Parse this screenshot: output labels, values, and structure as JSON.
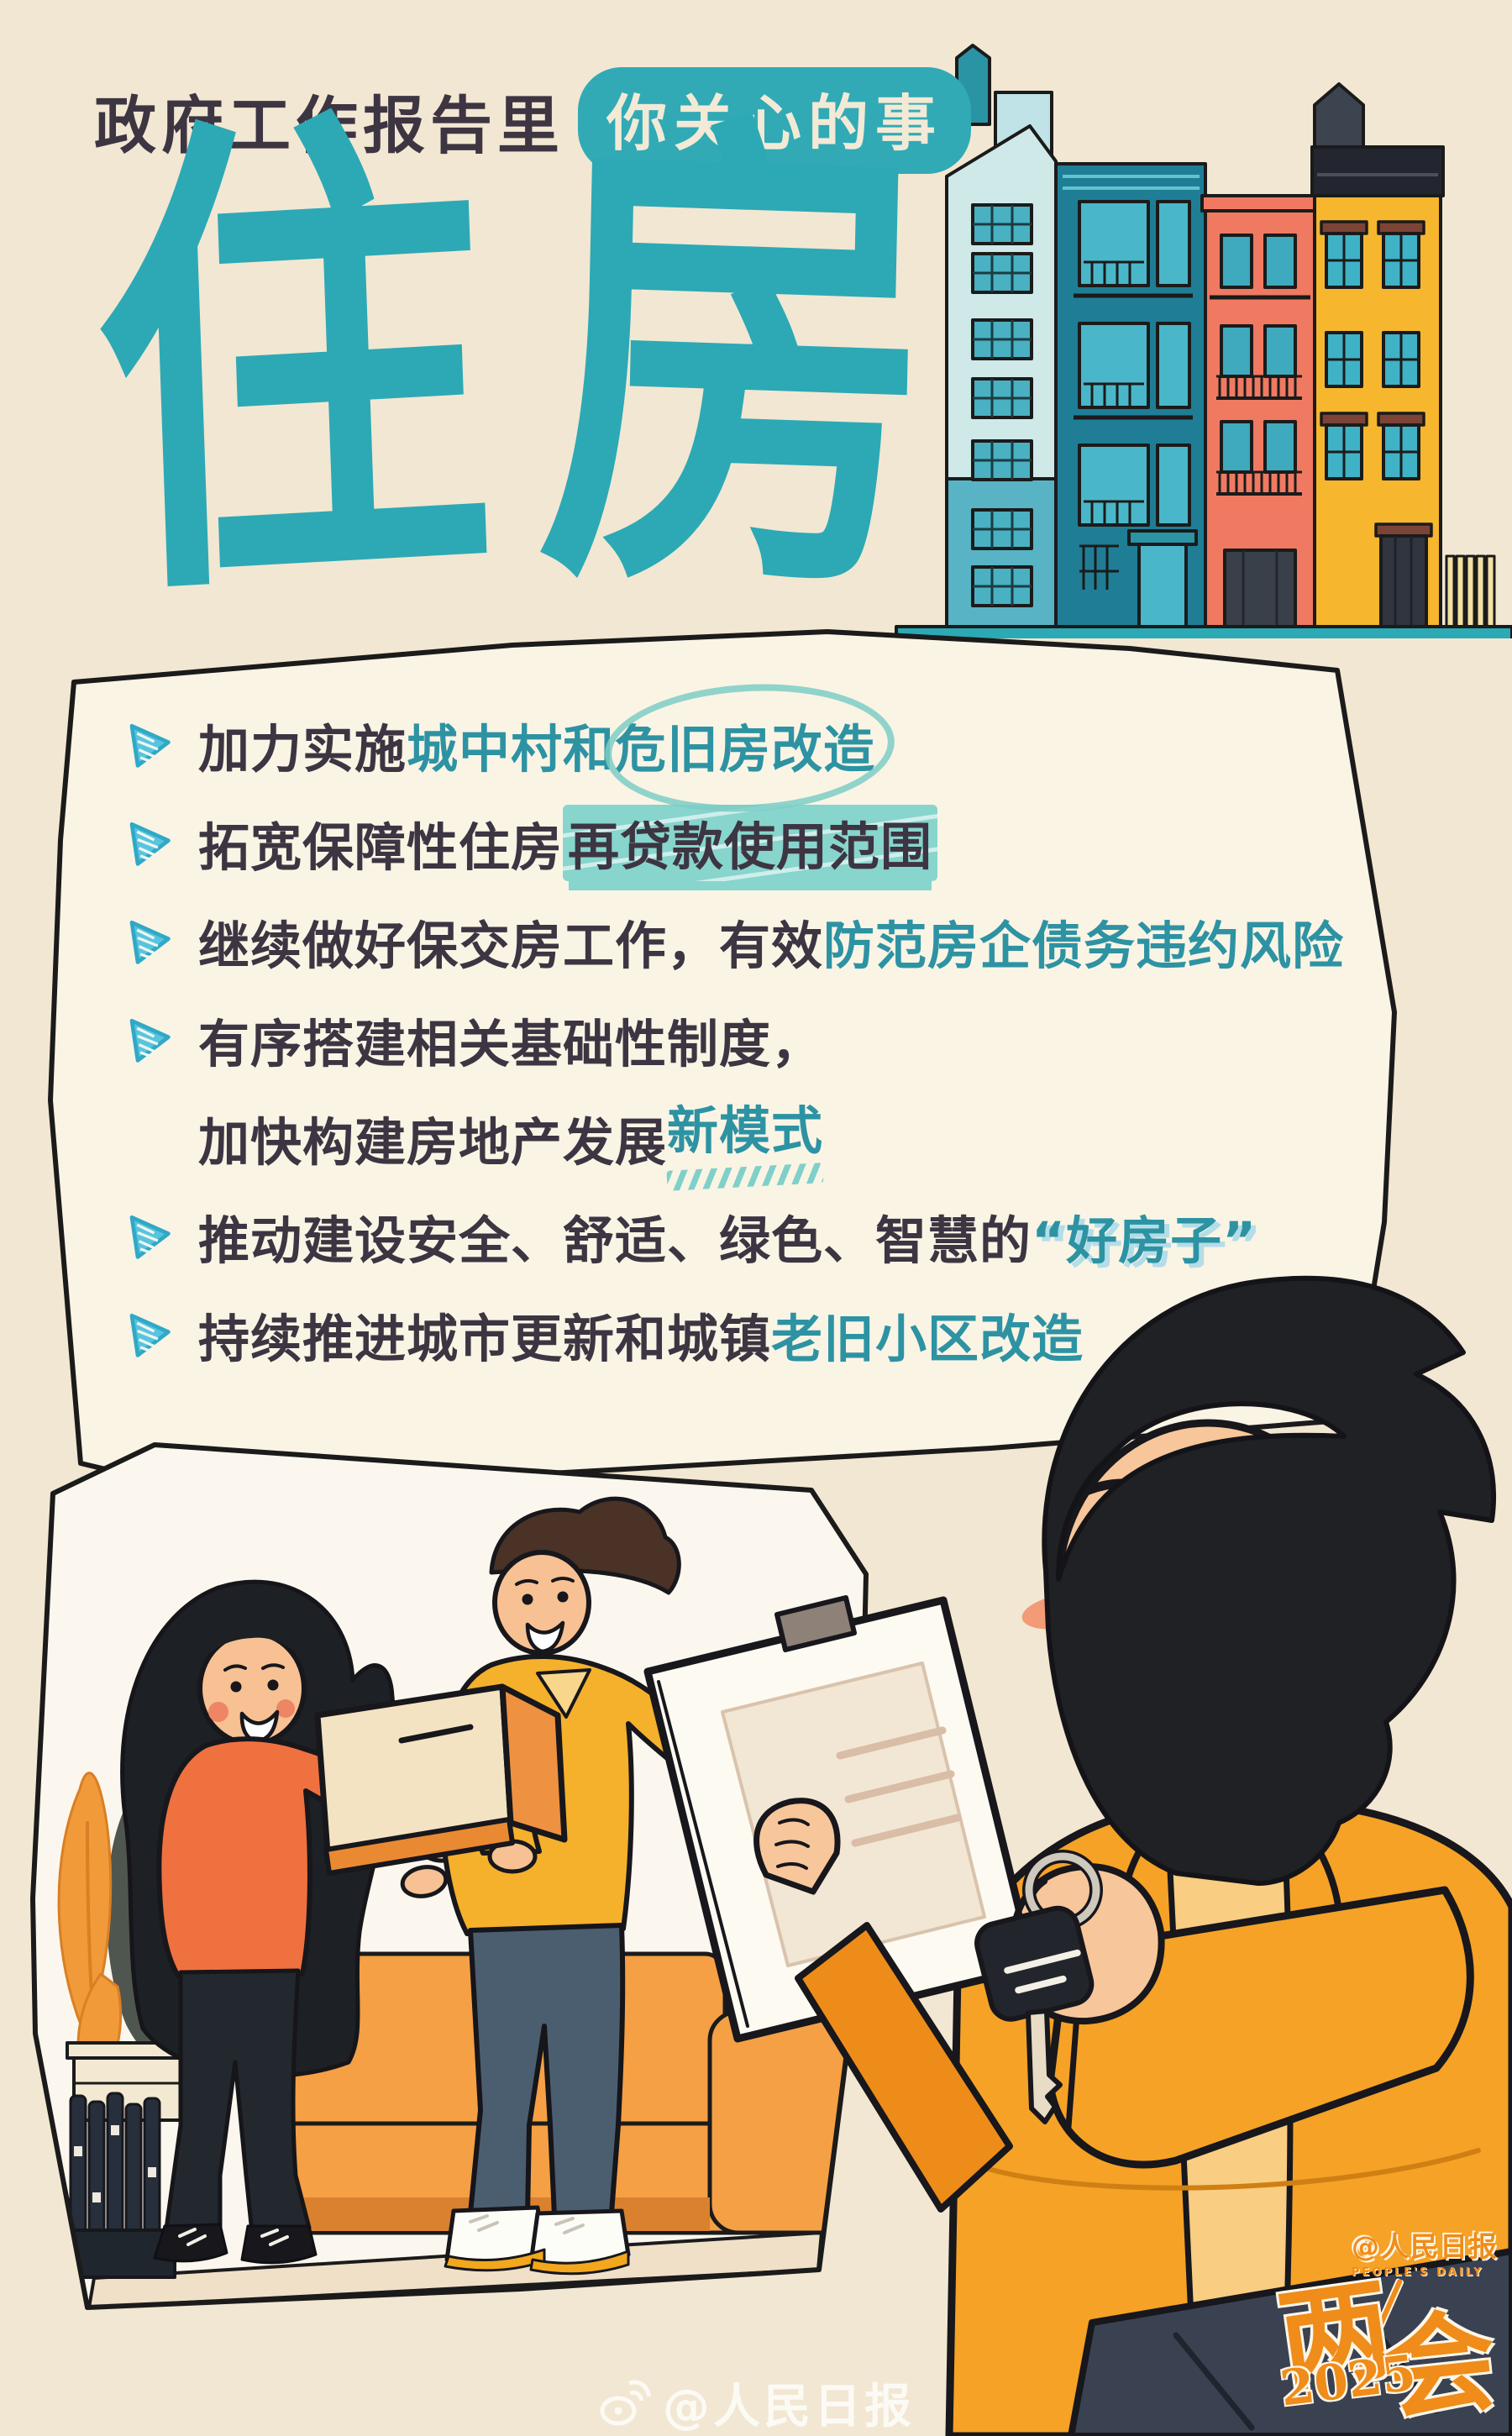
{
  "header": {
    "prefix": "政府工作报告里",
    "pill": "你关心的事"
  },
  "title": {
    "char1": "住",
    "char2": "房",
    "full": "住房"
  },
  "bullets": {
    "items": [
      {
        "lines": [
          {
            "arrow": true,
            "segs": [
              {
                "t": "加力实施",
                "c": "dark"
              },
              {
                "t": "城中村和",
                "c": "teal"
              },
              {
                "t": "危旧房改造",
                "c": "circled"
              }
            ]
          }
        ]
      },
      {
        "lines": [
          {
            "arrow": true,
            "segs": [
              {
                "t": "拓宽保障性住房",
                "c": "dark"
              },
              {
                "t": "再贷款使用范围",
                "c": "hl"
              }
            ]
          }
        ]
      },
      {
        "lines": [
          {
            "arrow": true,
            "segs": [
              {
                "t": "继续做好保交房工作，有效",
                "c": "dark"
              },
              {
                "t": "防范房企债务违约风险",
                "c": "teal"
              }
            ]
          }
        ]
      },
      {
        "lines": [
          {
            "arrow": true,
            "segs": [
              {
                "t": "有序搭建相关基础性制度，",
                "c": "dark"
              }
            ]
          },
          {
            "arrow": false,
            "segs": [
              {
                "t": "加快构建房地产发展",
                "c": "dark"
              },
              {
                "t": "新模式",
                "c": "squig"
              }
            ]
          }
        ]
      },
      {
        "lines": [
          {
            "arrow": true,
            "segs": [
              {
                "t": "推动建设安全、舒适、绿色、智慧的",
                "c": "dark"
              },
              {
                "t": "“好房子”",
                "c": "quote"
              }
            ]
          }
        ]
      },
      {
        "lines": [
          {
            "arrow": true,
            "segs": [
              {
                "t": "持续推进城市更新和城镇",
                "c": "dark"
              },
              {
                "t": "老旧小区改造",
                "c": "teal"
              }
            ]
          }
        ]
      }
    ]
  },
  "watermark": {
    "text": "@人民日报",
    "icon": "weibo-icon"
  },
  "logo": {
    "hui1": "两",
    "hui2": "会",
    "year": "2025",
    "brand": "@人民日报",
    "brand_sub": "PEOPLE'S DAILY"
  },
  "icons": {
    "bullet_marker": "arrow-right-icon",
    "footer": "weibo-icon"
  },
  "colors": {
    "background": "#f2e7d2",
    "panel": "#faf4e5",
    "title_teal": "#2ca9b5",
    "bullet_teal": "#2d93a3",
    "bullet_dark": "#3d3542",
    "pill": "#31aab6",
    "arrow": "#59c4de",
    "highlight": "#87d5cd",
    "logo_orange": "#ef8c1a",
    "building_light": "#cfe9e9",
    "building_dark_teal": "#1f7e95",
    "building_coral": "#ef7a61",
    "building_yellow": "#f6b62e",
    "jacket_orange": "#f5a226",
    "sweater_orange": "#ef7140",
    "couch_orange": "#f5a044"
  }
}
